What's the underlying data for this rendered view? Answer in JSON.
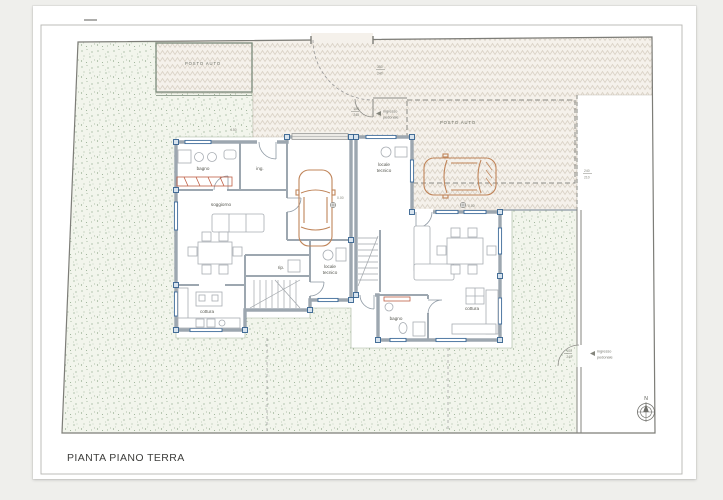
{
  "sheet": {
    "title": "PIANTA PIANO TERRA"
  },
  "compass": {
    "north": "N"
  },
  "site": {
    "parking_left": "POSTO AUTO",
    "parking_right": "POSTO AUTO",
    "gate_top": {
      "l1": "ingresso",
      "l2": "pedonale",
      "w": "100",
      "h": "240"
    },
    "gate_right": {
      "l1": "ingresso",
      "l2": "pedonale",
      "w": "100",
      "h": "240"
    },
    "driveway_gate": {
      "w": "350",
      "h": "240"
    },
    "carport_dim": {
      "w": "240",
      "h": "210"
    },
    "misc_dim": "4.50",
    "level": "0.00"
  },
  "left": {
    "bagno": "bagno",
    "ing": "ing.",
    "soggiorno": "soggiorno",
    "cottura": "cottura",
    "rip": "rip.",
    "locale1": "locale",
    "locale2": "tecnico"
  },
  "right": {
    "locale1": "locale",
    "locale2": "tecnico",
    "bagno": "bagno",
    "cottura": "cottura"
  },
  "colors": {
    "garden": "#f2f5ec",
    "garden_dot": "#87a183",
    "paving": "#f5f1eb",
    "paving_line": "#d9d1c5",
    "wall": "#9da7b0",
    "window_accent": "#3c6a99",
    "car_outline": "#c0855a",
    "fixture_orange": "#bf5f45",
    "line": "#8b8b8b"
  }
}
